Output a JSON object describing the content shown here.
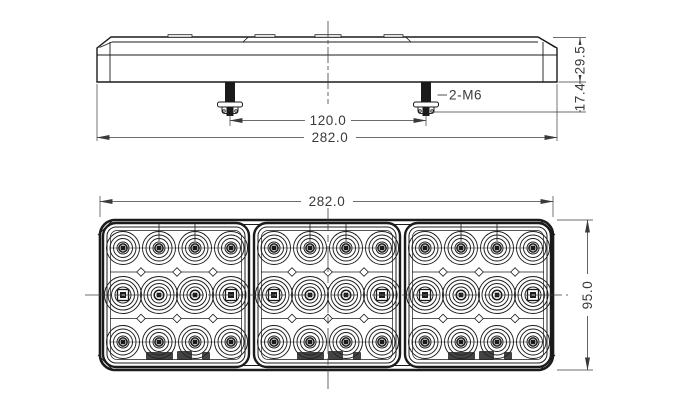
{
  "drawing": {
    "background_color": "#ffffff",
    "line_color": "#1b1b1b",
    "dim_color": "#3a3a3a",
    "views": {
      "top_view": {
        "overall_width_label": "282.0",
        "stud_spacing_label": "120.0",
        "body_height_label": "29.5",
        "stud_length_label": "17.4",
        "stud_note": "2-M6",
        "mounting_studs": 2
      },
      "front_view": {
        "width_label": "282.0",
        "height_label": "95.0",
        "panels": 3,
        "led_columns": 4,
        "led_rows": 3
      }
    }
  }
}
